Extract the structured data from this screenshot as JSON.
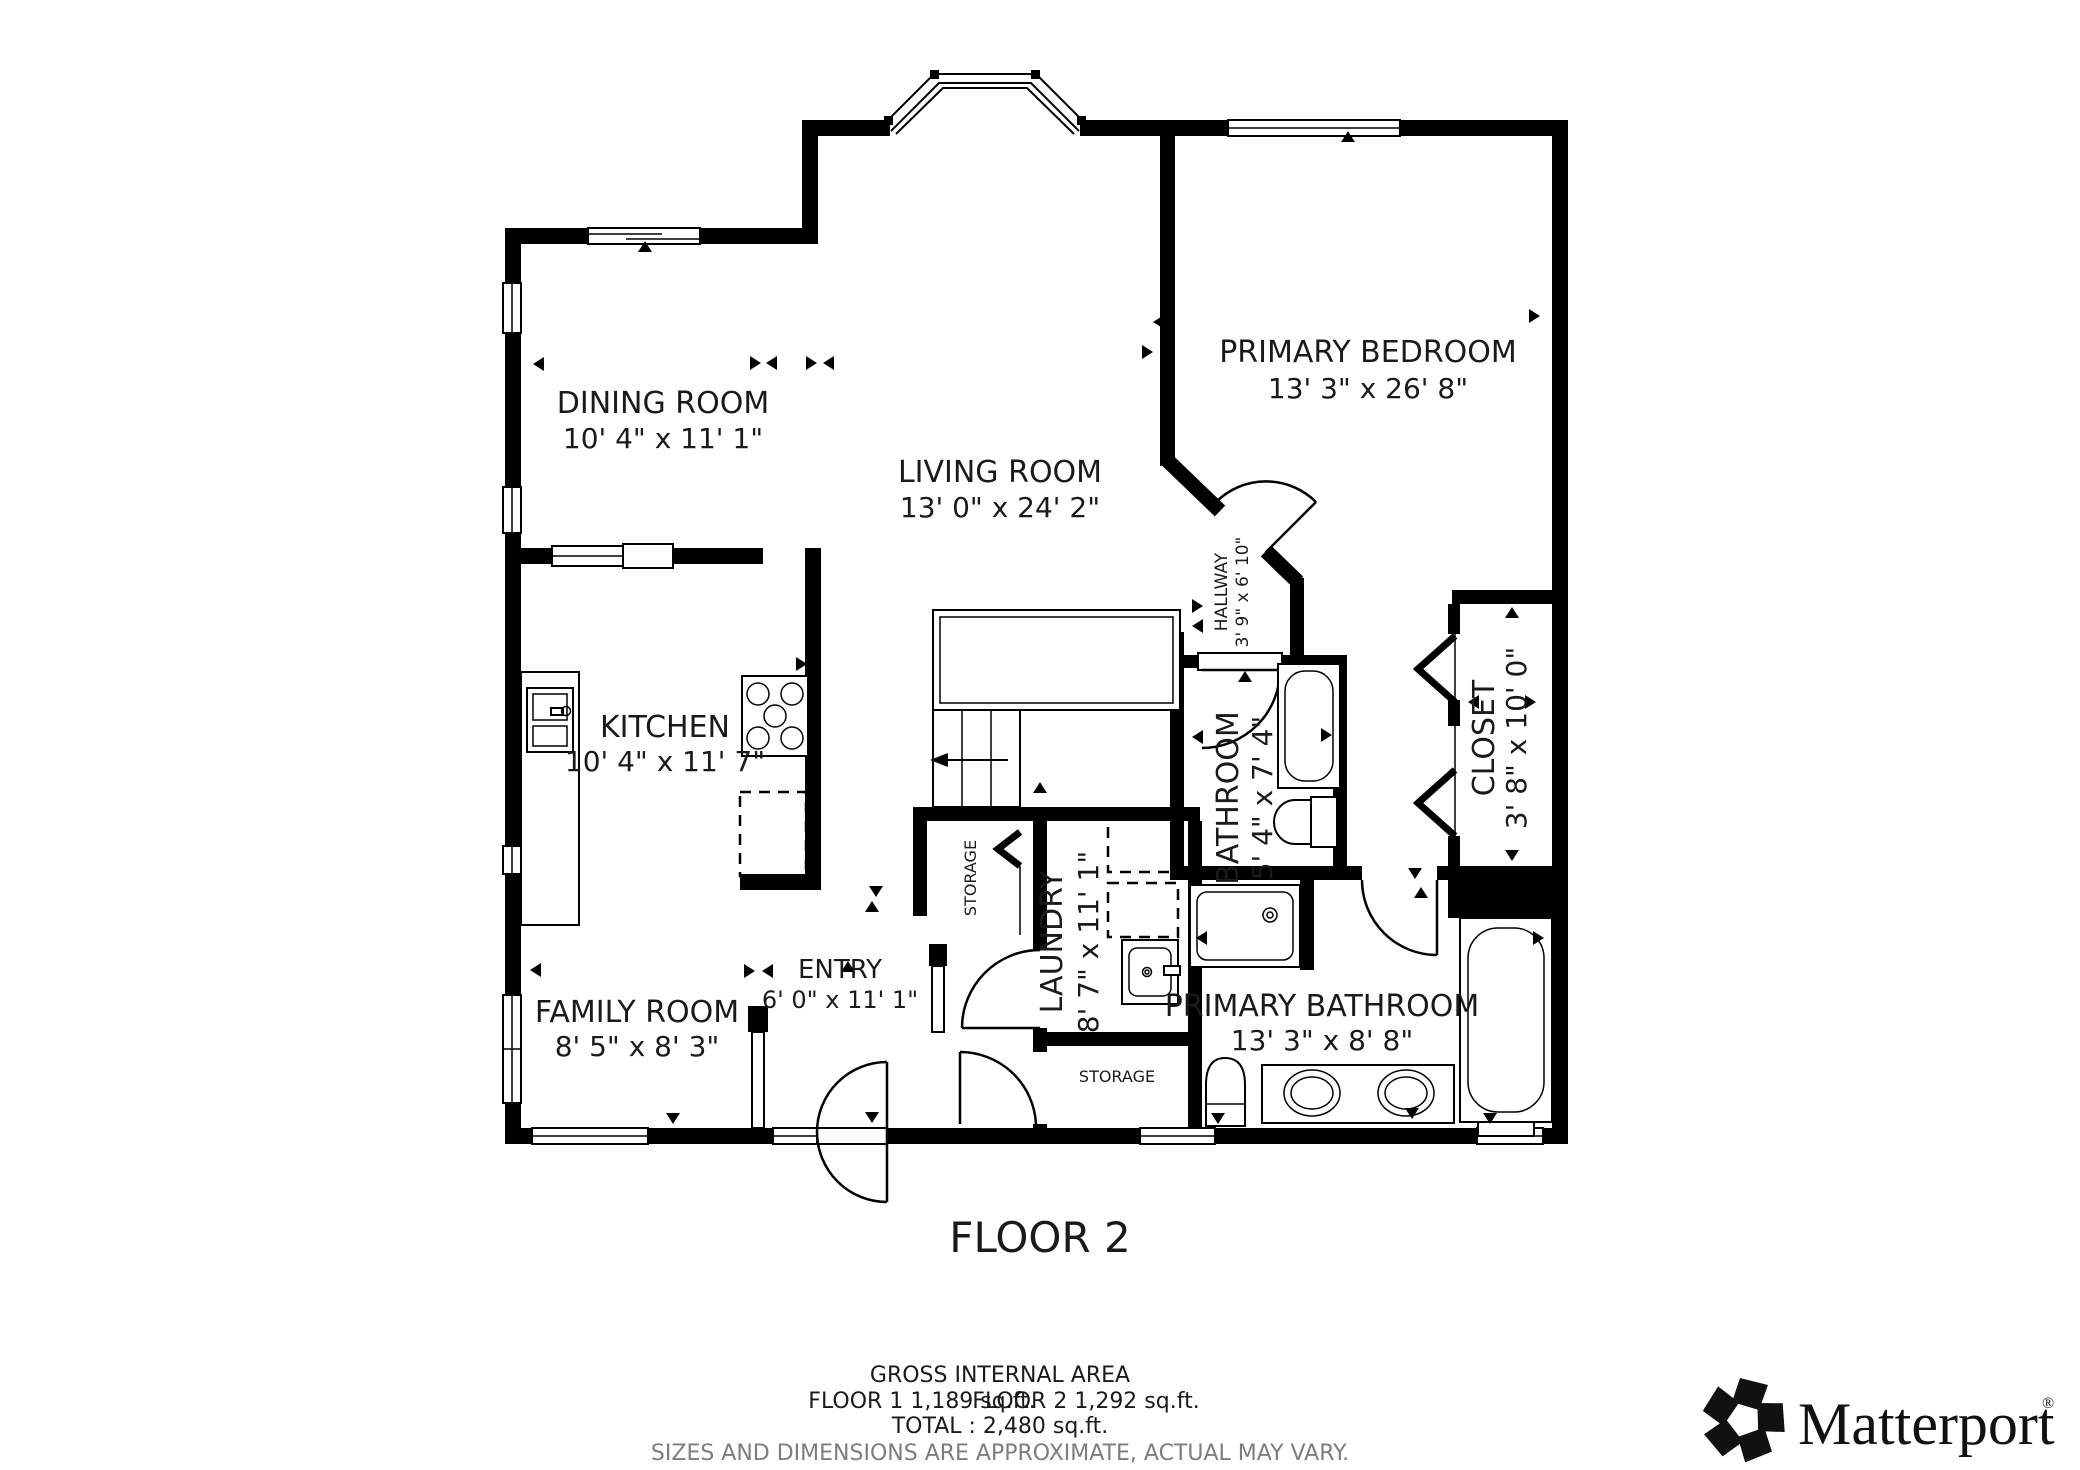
{
  "floor_plan": {
    "floor_label": "FLOOR 2",
    "rooms": {
      "dining_room": {
        "name": "DINING ROOM",
        "dims": "10' 4\" x 11' 1\""
      },
      "living_room": {
        "name": "LIVING ROOM",
        "dims": "13' 0\" x 24' 2\""
      },
      "primary_bedroom": {
        "name": "PRIMARY BEDROOM",
        "dims": "13' 3\" x 26' 8\""
      },
      "kitchen": {
        "name": "KITCHEN",
        "dims": "10' 4\" x 11' 7\""
      },
      "family_room": {
        "name": "FAMILY ROOM",
        "dims": "8' 5\" x 8' 3\""
      },
      "entry": {
        "name": "ENTRY",
        "dims": "6' 0\" x 11' 1\""
      },
      "laundry": {
        "name": "LAUNDRY",
        "dims": "8' 7\" x 11' 1\""
      },
      "bathroom": {
        "name": "BATHROOM",
        "dims": "5' 4\" x 7' 4\""
      },
      "hallway": {
        "name": "HALLWAY",
        "dims": "3' 9\" x 6' 10\""
      },
      "closet": {
        "name": "CLOSET",
        "dims": "3' 8\" x 10' 0\""
      },
      "primary_bathroom": {
        "name": "PRIMARY BATHROOM",
        "dims": "13' 3\" x 8' 8\""
      },
      "storage_upper": {
        "name": "STORAGE"
      },
      "storage_lower": {
        "name": "STORAGE"
      }
    },
    "footer": {
      "title": "GROSS INTERNAL AREA",
      "floor1_area": "FLOOR 1 1,189 sq.ft.",
      "floor2_area": "FLOOR 2 1,292 sq.ft.",
      "total": "TOTAL :  2,480 sq.ft.",
      "disclaimer": "SIZES AND DIMENSIONS ARE APPROXIMATE, ACTUAL MAY VARY."
    },
    "branding": {
      "icon": "matterport-pinwheel-icon",
      "logo_text": "Matterport",
      "registered_mark": "®"
    },
    "colors": {
      "walls": "#000000",
      "background": "#ffffff",
      "disclaimer_text": "#7d7d7d"
    }
  }
}
